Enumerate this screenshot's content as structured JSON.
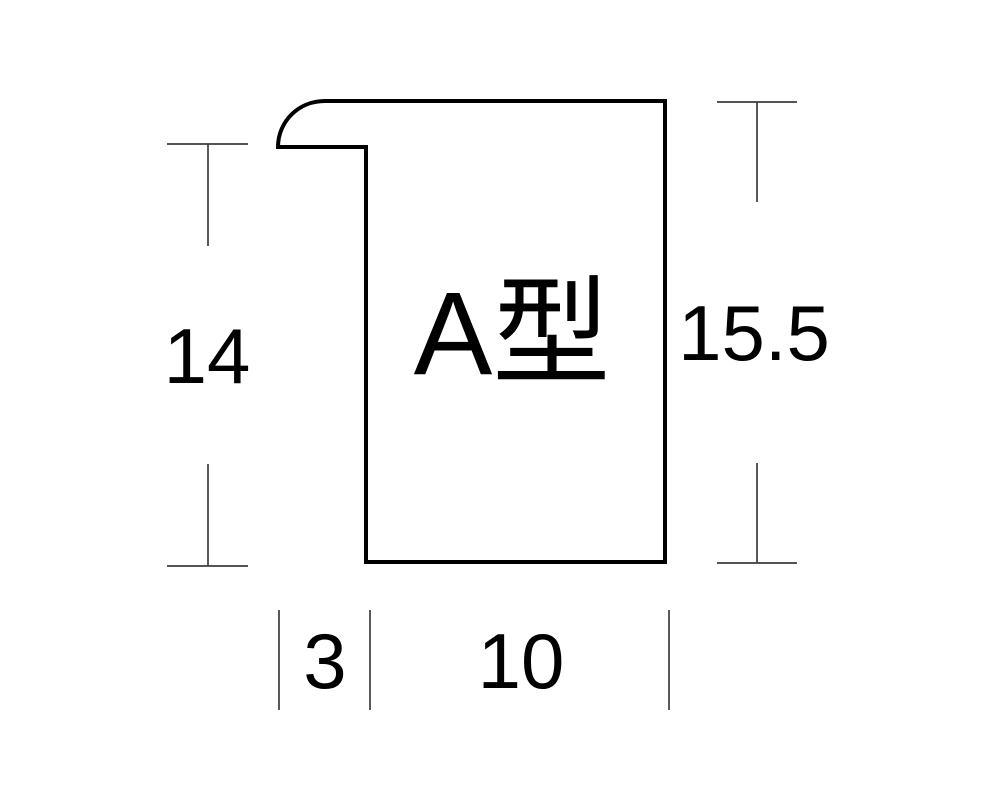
{
  "figure": {
    "profile_name": "A型",
    "dimensions": {
      "left_height": "14",
      "overall_height": "15.5",
      "lip_width": "3",
      "body_width": "10"
    }
  },
  "colors": {
    "outline": "#000000",
    "dimension_line": "#3c3c3c",
    "background": "#ffffff"
  }
}
